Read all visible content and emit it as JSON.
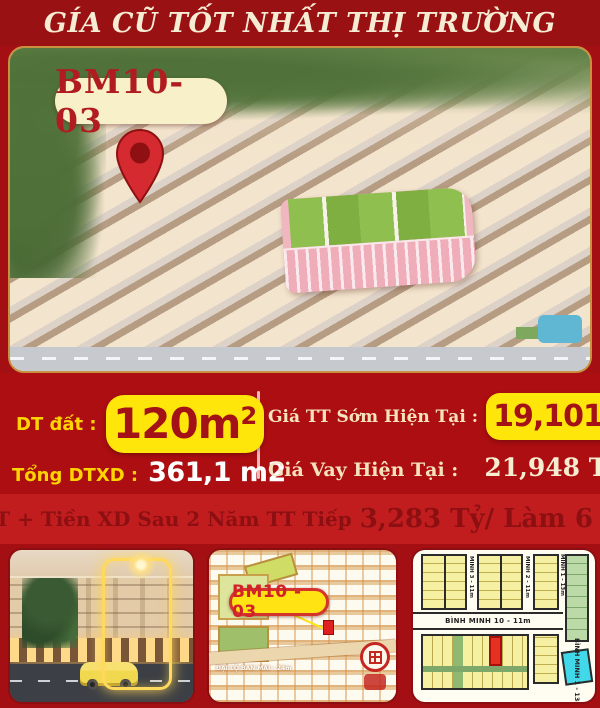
{
  "header": {
    "title": "GÍA CŨ TỐT NHẤT THỊ TRƯỜNG"
  },
  "hero": {
    "lot_label": "BM10-03",
    "pin_icon": "map-pin-icon"
  },
  "info": {
    "dt_dat_label": "DT đất :",
    "dt_dat_value": "120m",
    "dt_dat_sup": "2",
    "tong_dtxd_label": "Tổng DTXD :",
    "tong_dtxd_value": "361,1 m2",
    "gia_tt_label": "Giá TT Sớm Hiện Tại :",
    "gia_tt_value": "19,101Tỷ",
    "gia_vay_label": "Giá Vay Hiện Tại :",
    "gia_vay_value": "21,948 Tỷ"
  },
  "banner": {
    "text_normal": "KPBT + Tiền XD Sau 2 Năm TT Tiếp",
    "text_big": "3,283 Tỷ/ Làm 6 Đợt"
  },
  "site_map": {
    "lot_label": "BM10 - 03",
    "street_label": "ĐẠI LỘ BAN MAI - 24m"
  },
  "plat_map": {
    "street_h": "BÌNH MINH 10 - 11m",
    "street_v_right": "BÌNH MINH 1 - 13m",
    "street_v_top": [
      "MINH 3 - 11m",
      "MINH 2 - 11m",
      "MINH 1 - 13m"
    ]
  },
  "colors": {
    "background_red": "#a30f13",
    "banner_red": "#c11d1f",
    "highlight_yellow": "#ffe60a",
    "label_yellow": "#ffd400",
    "dark_red_text": "#a31216",
    "cream_text": "#f6ecd4",
    "pin_red": "#d42a30",
    "lot_red": "#e53022",
    "lot_cyan": "#41d9ea"
  }
}
